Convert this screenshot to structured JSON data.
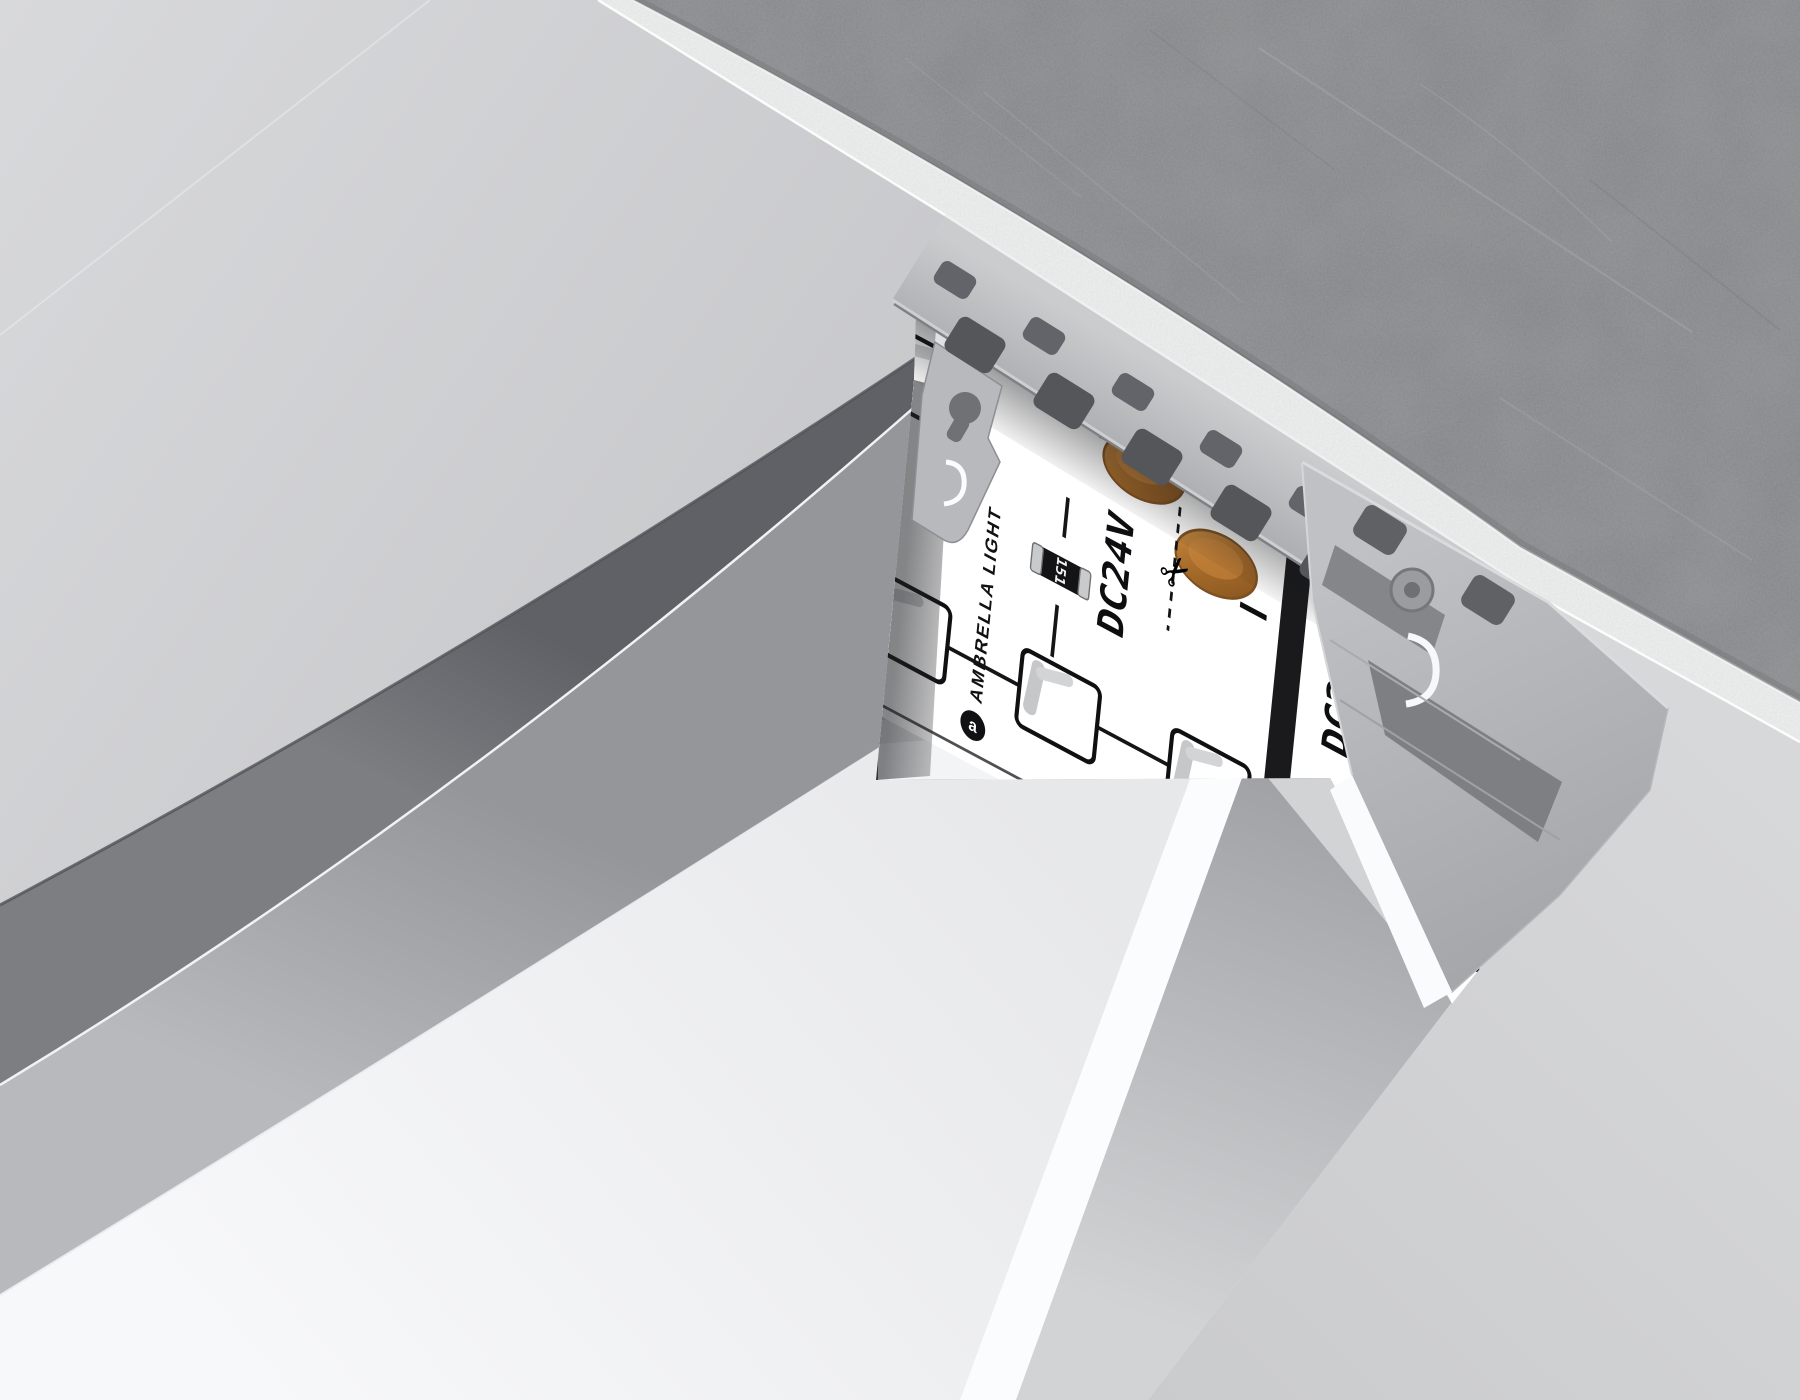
{
  "strip_print": {
    "brand": "AMBRELLA LIGHT",
    "voltage": "DC24V",
    "plus": "+",
    "minus": "−",
    "resistor_code": "151",
    "scissors_mark": "✂",
    "logo_letter": "a"
  },
  "colors": {
    "ceiling": "#cfd0d2",
    "concrete": "#8d8e91",
    "plaster": "#eceded",
    "shadow_gap": "#6f7074",
    "profile_side": "#a8a9ac",
    "diffuser": "#f2f3f5",
    "backdrop": "#cfd0d2",
    "aluminum": "#b6b7ba",
    "copper_pad": "#b0772f",
    "pcb": "#ffffff"
  }
}
